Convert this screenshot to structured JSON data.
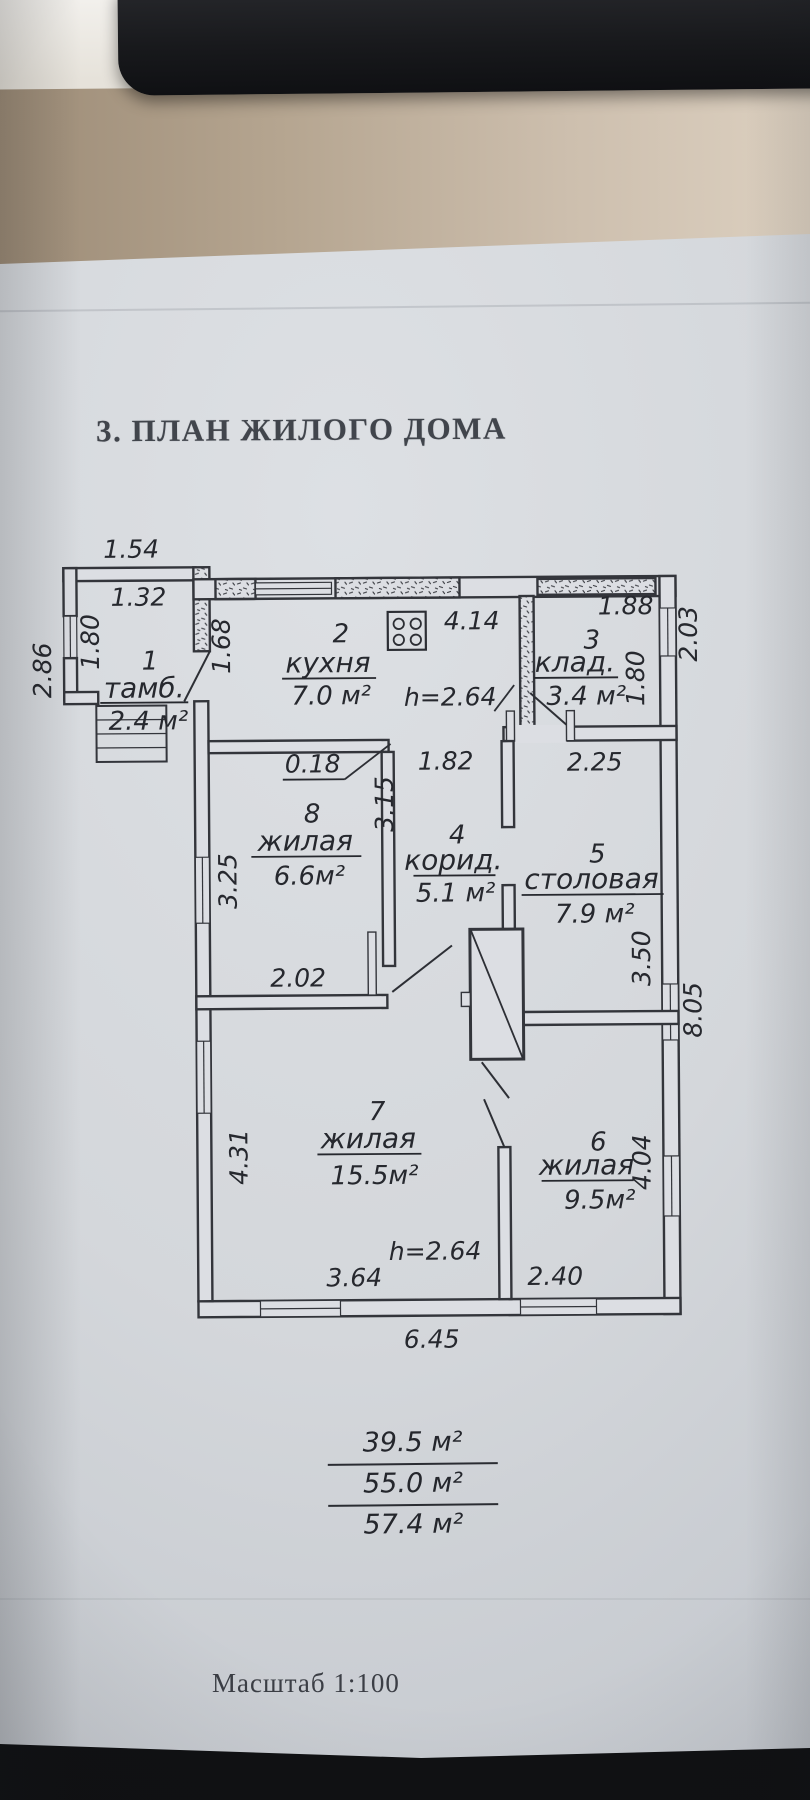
{
  "title": "3. ПЛАН ЖИЛОГО ДОМА",
  "scale": {
    "label": "Масштаб 1:100"
  },
  "summary": {
    "area1": "39.5 м²",
    "area2": "55.0 м²",
    "area3": "57.4 м²"
  },
  "rooms": {
    "r1": {
      "num": "1",
      "name": "тамб.",
      "area": "2.4 м²"
    },
    "r2": {
      "num": "2",
      "name": "кухня",
      "area": "7.0 м²"
    },
    "r3": {
      "num": "3",
      "name": "клад.",
      "area": "3.4 м²"
    },
    "r4": {
      "num": "4",
      "name": "корид.",
      "area": "5.1 м²"
    },
    "r5": {
      "num": "5",
      "name": "столовая",
      "area": "7.9 м²"
    },
    "r6": {
      "num": "6",
      "name": "жилая",
      "area": "9.5м²"
    },
    "r7": {
      "num": "7",
      "name": "жилая",
      "area": "15.5м²"
    },
    "r8": {
      "num": "8",
      "name": "жилая",
      "area": "6.6м²"
    }
  },
  "dims": {
    "annex_top_outer": "1.54",
    "annex_top_inner": "1.32",
    "annex_left": "1.80",
    "outer_left": "2.86",
    "kitchen_left": "1.68",
    "kitchen_top": "4.14",
    "pantry_top": "1.88",
    "pantry_right": "1.80",
    "outer_top_right": "2.03",
    "wall_thickness": "0.18",
    "corridor_top": "1.82",
    "dining_top": "2.25",
    "room8_right": "3.15",
    "room8_left": "3.25",
    "room7_top": "2.02",
    "dining_right": "3.50",
    "outer_right": "8.05",
    "room7_left": "4.31",
    "room6_right": "4.04",
    "room7_bottom": "3.64",
    "room6_bottom": "2.40",
    "bottom_outer": "6.45",
    "height_upper": "h=2.64",
    "height_lower": "h=2.64"
  }
}
